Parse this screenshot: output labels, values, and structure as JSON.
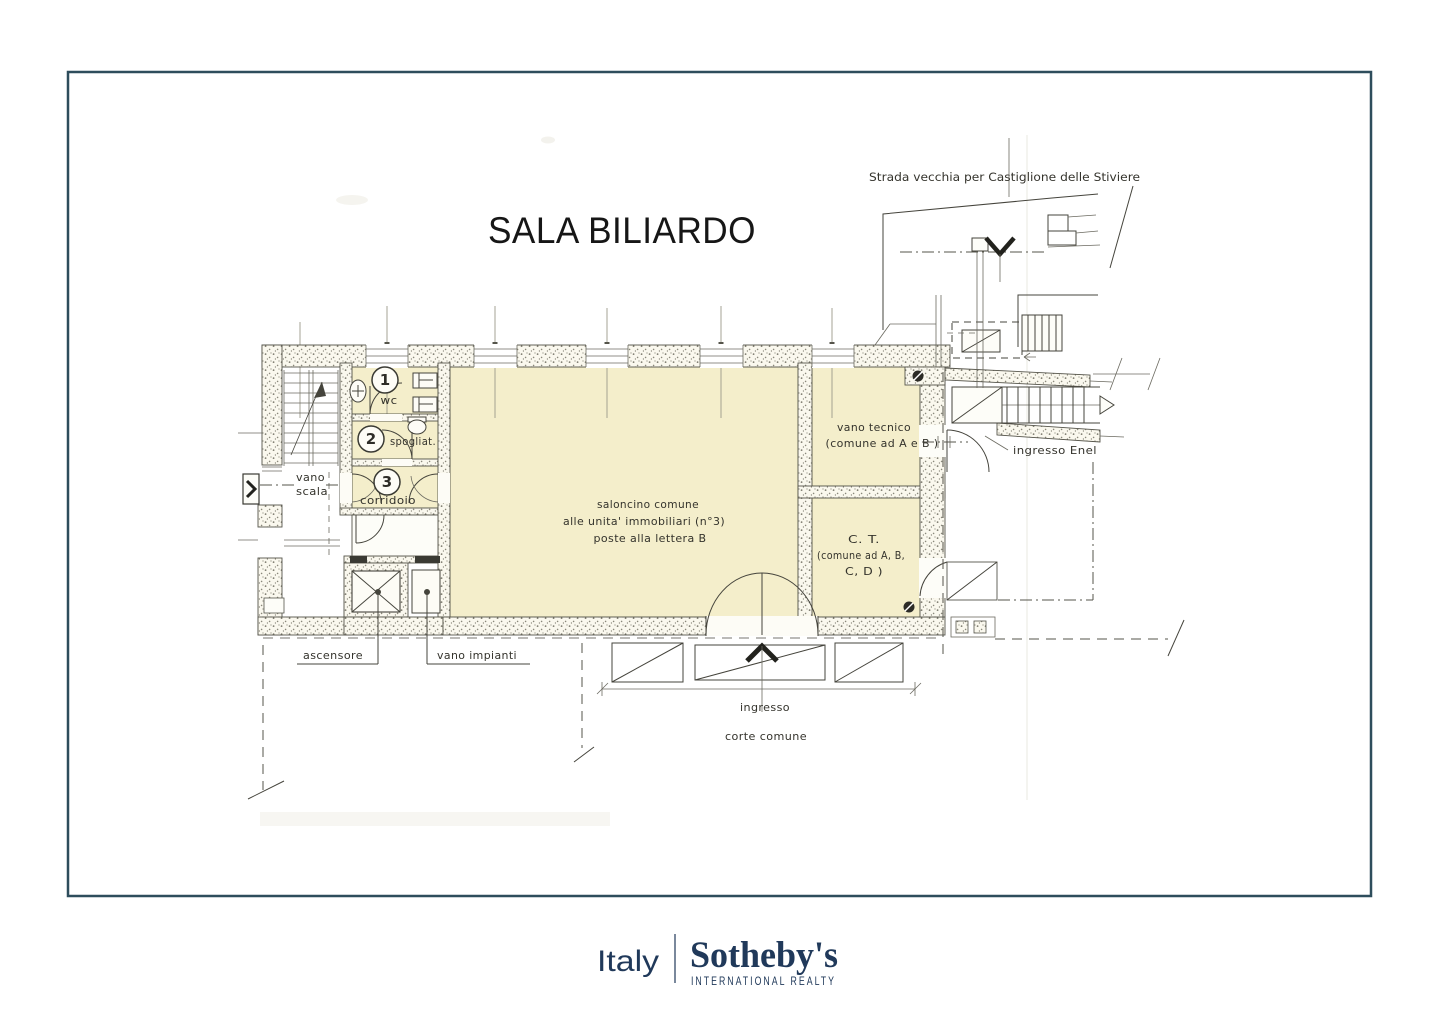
{
  "title": "SALA BILIARDO",
  "plan": {
    "road_label": "Strada vecchia per Castiglione delle Stiviere",
    "rooms": {
      "saloncino_line1": "saloncino comune",
      "saloncino_line2": "alle unita' immobiliari (n°3)",
      "saloncino_line3": "poste alla lettera B",
      "vano_tecnico_line1": "vano tecnico",
      "vano_tecnico_line2": "(comune ad A e B )",
      "ct_line1": "C. T.",
      "ct_line2": "(comune ad A, B,",
      "ct_line3": "C, D )",
      "wc": "wc",
      "spogliatoio": "spogliat.",
      "corridoio": "corridoio",
      "vano_scala_line1": "vano",
      "vano_scala_line2": "scala",
      "ascensore": "ascensore",
      "vano_impianti": "vano impianti"
    },
    "numbers": {
      "one": "1",
      "two": "2",
      "three": "3"
    },
    "outdoor": {
      "ingresso_enel": "ingresso Enel",
      "ingresso": "ingresso",
      "corte_comune": "corte comune"
    }
  },
  "footer": {
    "region": "Italy",
    "brand": "Sotheby's",
    "subbrand": "INTERNATIONAL REALTY"
  },
  "colors": {
    "frame": "#2e4d5c",
    "navy": "#20395a",
    "room_fill": "#f4eecb",
    "ink": "#45443c"
  }
}
